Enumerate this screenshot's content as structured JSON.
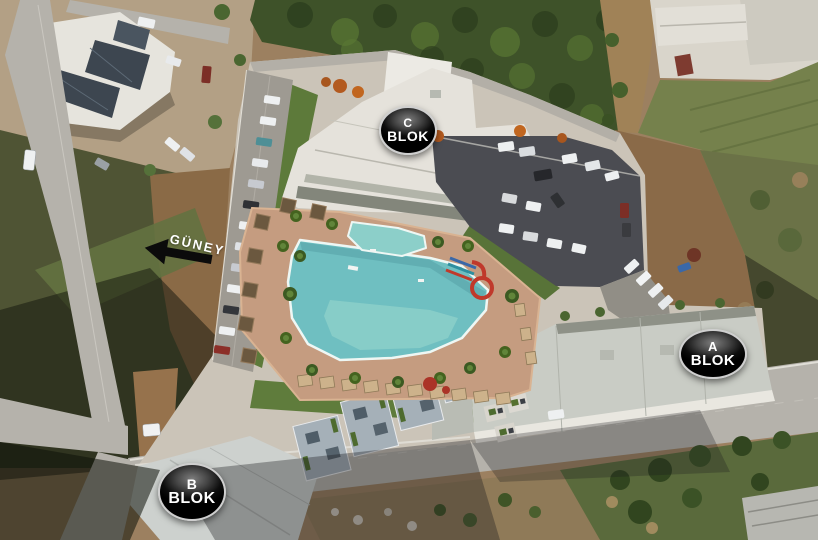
{
  "image": {
    "type": "aerial-render-site-plan",
    "labels": {
      "block_c": {
        "letter": "C",
        "word": "BLOK"
      },
      "block_a": {
        "letter": "A",
        "word": "BLOK"
      },
      "block_b": {
        "letter": "B",
        "word": "BLOK"
      },
      "direction_label": "GÜNEY"
    },
    "colors": {
      "pool_water": "#6fbfc1",
      "pool_water_shallow": "#8ccfc9",
      "pool_deck": "#c59c80",
      "road": "#b5b2ab",
      "dark_parking": "#4b4c52",
      "site_base": "#cbc4b8",
      "building_white": "#e5e2db",
      "building_gray": "#c9ccc5",
      "block_b_roof": "#a5b0b8",
      "trees_dark": "#3e5229",
      "grass": "#5d7a3a",
      "dirt": "#9c8060",
      "dirt_light": "#b3a085",
      "badge_text": "#ffffff",
      "badge_border": "#cfcfcf",
      "direction_text": "#ffffff",
      "arrow_black": "#0b0b0b",
      "waterslide_red": "#c0392b",
      "waterslide_blue": "#3a68a8"
    }
  }
}
